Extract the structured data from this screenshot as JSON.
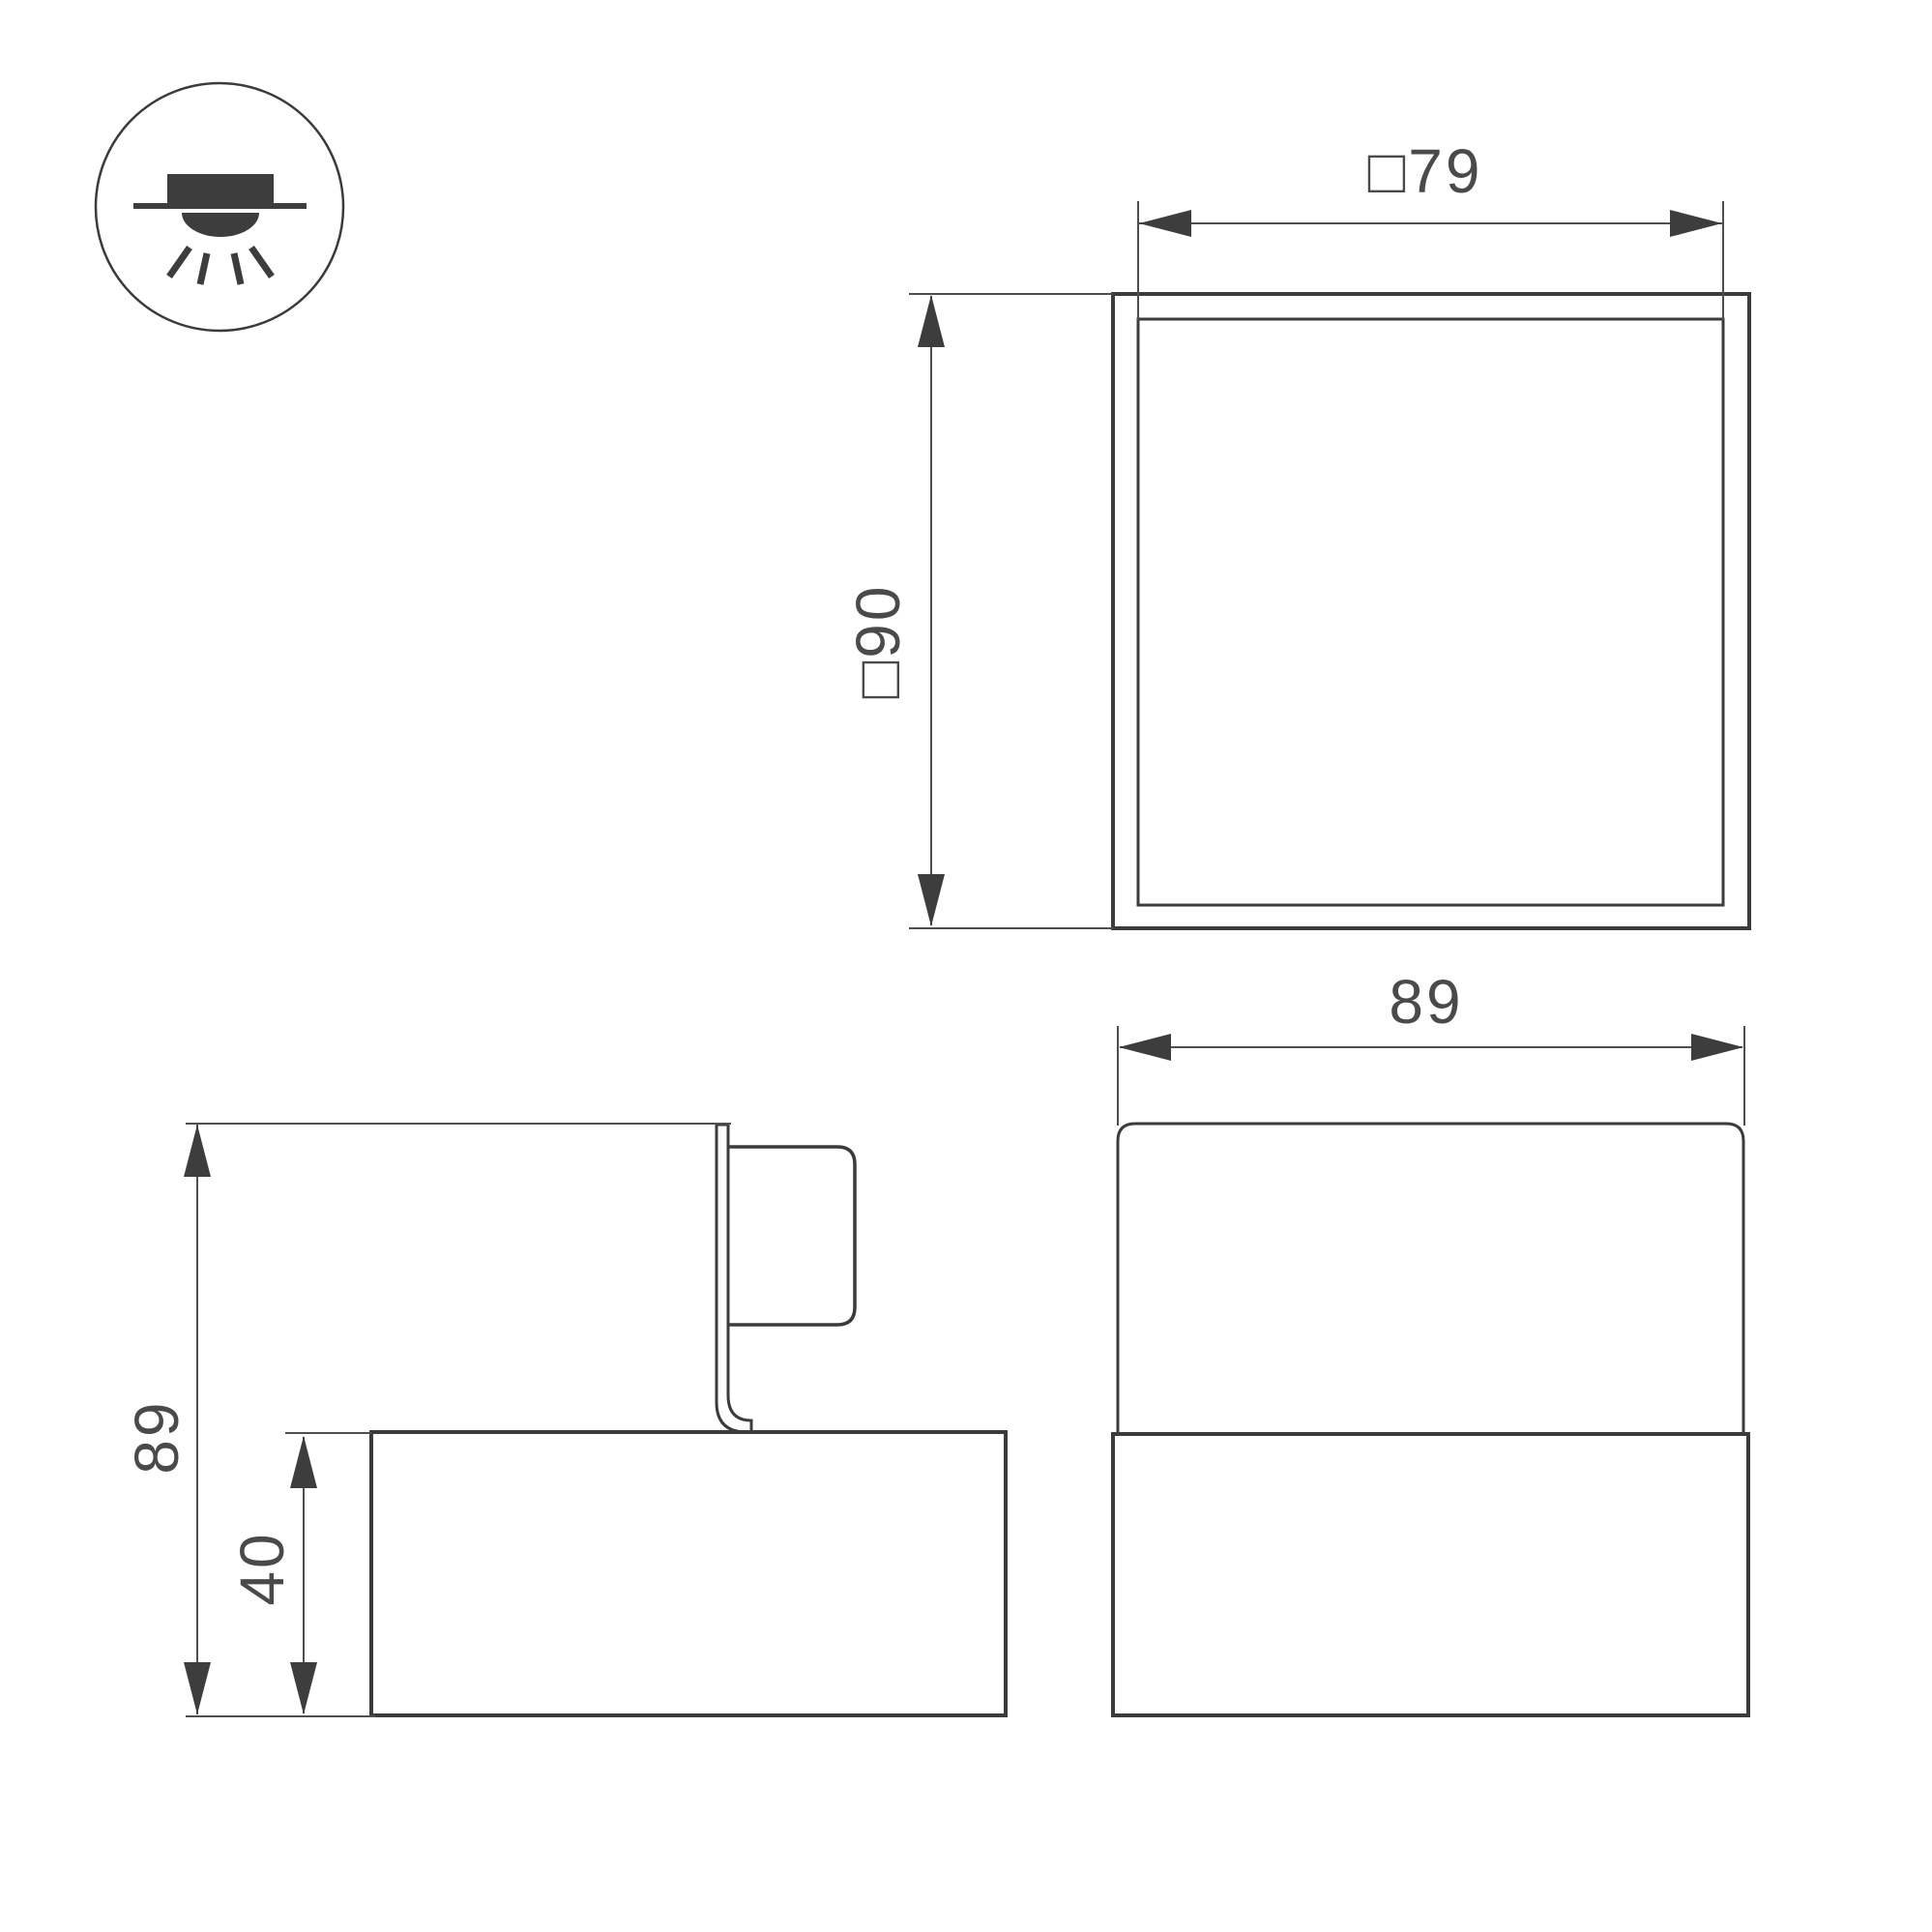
{
  "page": {
    "background": "#ffffff",
    "outline_color": "#3b3b3b",
    "dimension_color": "#4f4f4f",
    "text_color": "#4a4a4a"
  },
  "icons": {
    "mount_type": "recessed-downlight-icon"
  },
  "views": {
    "plan": {
      "width_label": "□79",
      "height_label": "□90"
    },
    "side": {
      "height_label": "89",
      "base_height_label": "40"
    },
    "front": {
      "width_label": "89"
    }
  }
}
